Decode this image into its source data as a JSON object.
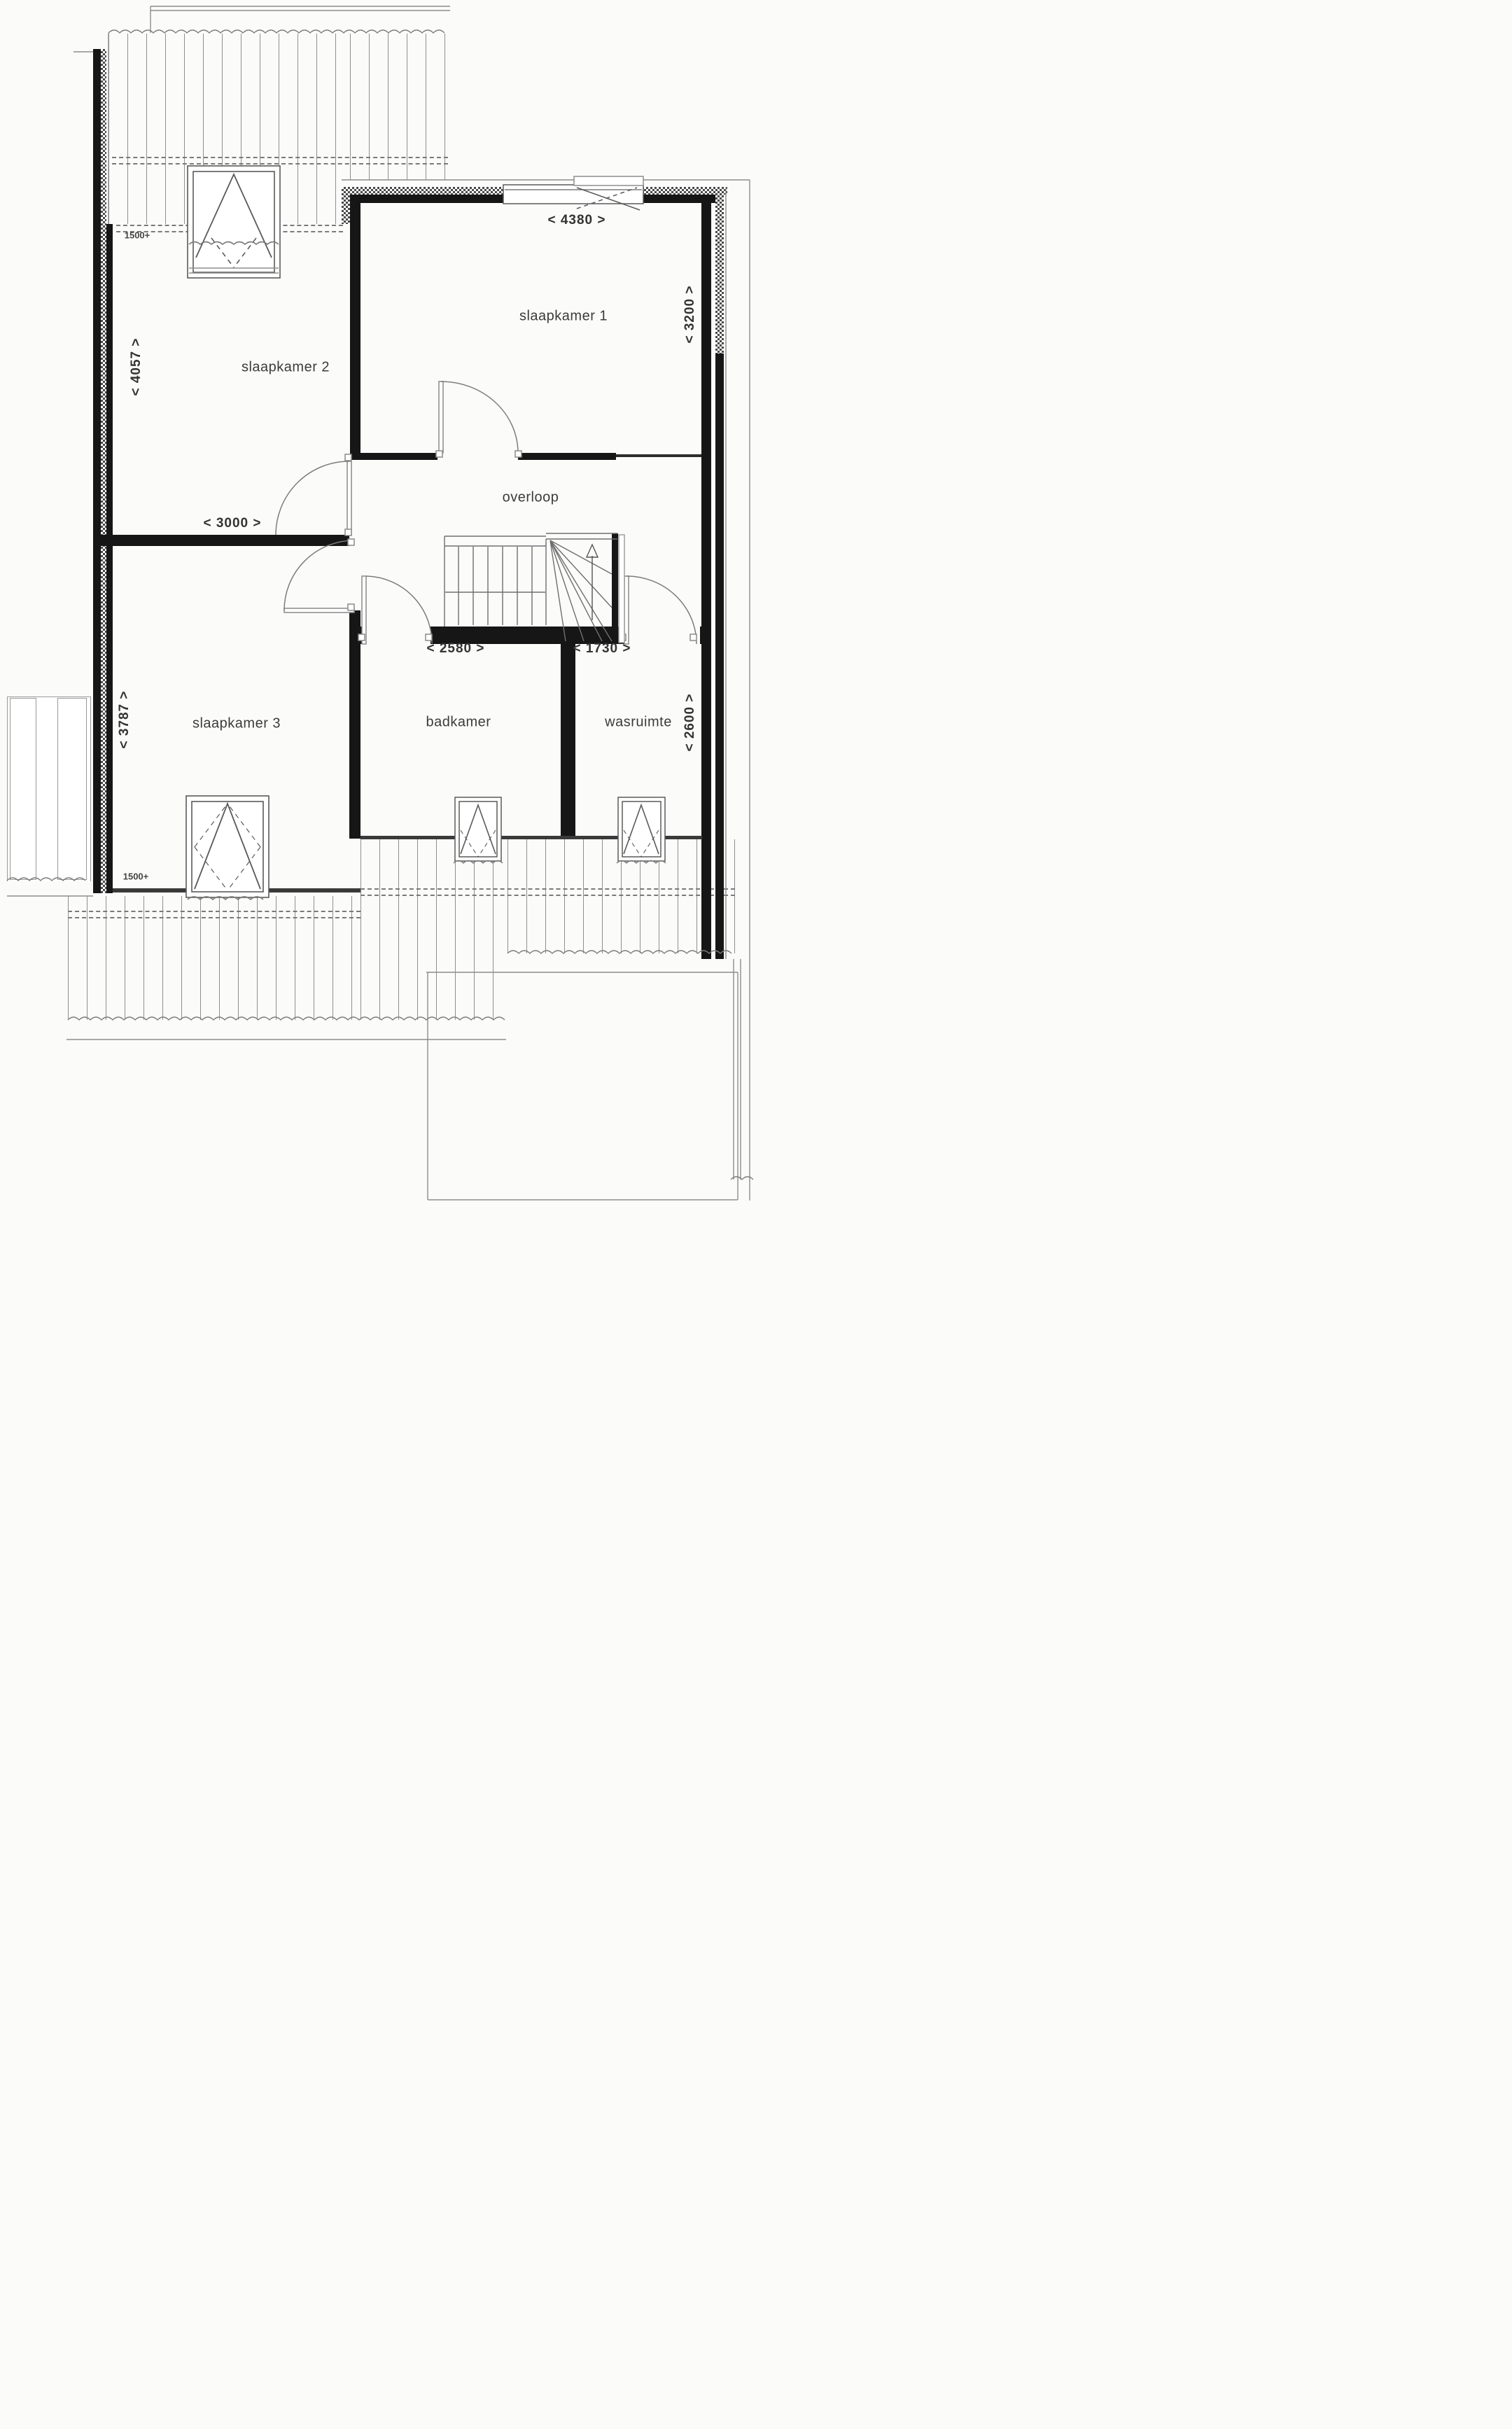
{
  "plan": {
    "title": "floor plan - attic storey",
    "rooms": [
      {
        "key": "slaapkamer-1",
        "label": "slaapkamer 1"
      },
      {
        "key": "slaapkamer-2",
        "label": "slaapkamer 2"
      },
      {
        "key": "slaapkamer-3",
        "label": "slaapkamer 3"
      },
      {
        "key": "overloop",
        "label": "overloop"
      },
      {
        "key": "badkamer",
        "label": "badkamer"
      },
      {
        "key": "wasruimte",
        "label": "wasruimte"
      }
    ],
    "dimensions": {
      "sl1_width": "< 4380 >",
      "sl1_depth": "< 3200 >",
      "sl2_depth": "< 4057 >",
      "sl2_width": "< 3000 >",
      "sl3_depth": "< 3787 >",
      "badkamer_width": "< 2580 >",
      "wasruimte_width": "< 1730 >",
      "wasruimte_depth": "< 2600 >"
    },
    "height_markers": {
      "top": "1500+",
      "bottom": "1500+"
    },
    "colors": {
      "wall": "#161616",
      "hatch": "#4a4a4a",
      "line": "#777777",
      "faint": "#999999",
      "text": "#3b3b3b"
    }
  }
}
